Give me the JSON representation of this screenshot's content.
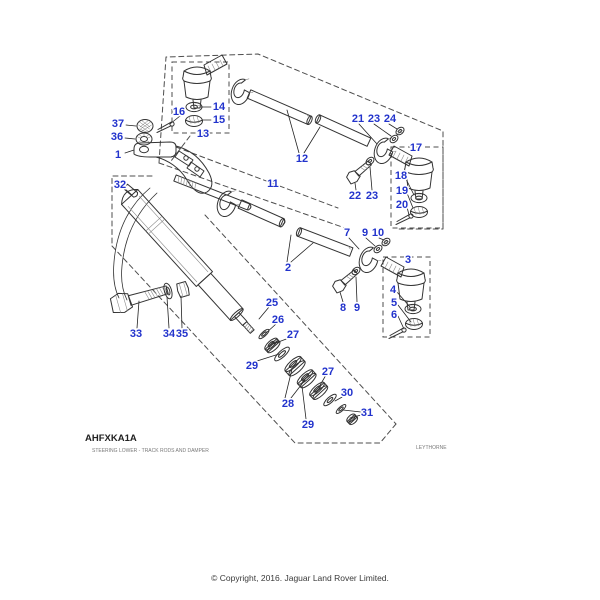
{
  "diagram": {
    "code": "AHFXKA1A",
    "subtitle": "STEERING LOWER - TRACK RODS AND DAMPER",
    "plant": "LEYTHORNE",
    "callout_color": "#2233cc",
    "callouts": [
      {
        "n": "1",
        "x": 118,
        "y": 155
      },
      {
        "n": "2",
        "x": 288,
        "y": 268
      },
      {
        "n": "3",
        "x": 408,
        "y": 260
      },
      {
        "n": "4",
        "x": 393,
        "y": 290
      },
      {
        "n": "5",
        "x": 394,
        "y": 303
      },
      {
        "n": "6",
        "x": 394,
        "y": 315
      },
      {
        "n": "7",
        "x": 347,
        "y": 233
      },
      {
        "n": "8",
        "x": 343,
        "y": 308
      },
      {
        "n": "9",
        "x": 365,
        "y": 233
      },
      {
        "n": "9",
        "x": 357,
        "y": 308
      },
      {
        "n": "10",
        "x": 378,
        "y": 233
      },
      {
        "n": "11",
        "x": 273,
        "y": 184
      },
      {
        "n": "12",
        "x": 302,
        "y": 159
      },
      {
        "n": "13",
        "x": 203,
        "y": 134
      },
      {
        "n": "14",
        "x": 219,
        "y": 107
      },
      {
        "n": "15",
        "x": 219,
        "y": 120
      },
      {
        "n": "16",
        "x": 179,
        "y": 112
      },
      {
        "n": "17",
        "x": 416,
        "y": 148
      },
      {
        "n": "18",
        "x": 401,
        "y": 176
      },
      {
        "n": "19",
        "x": 402,
        "y": 191
      },
      {
        "n": "20",
        "x": 402,
        "y": 205
      },
      {
        "n": "21",
        "x": 358,
        "y": 119
      },
      {
        "n": "22",
        "x": 355,
        "y": 196
      },
      {
        "n": "23",
        "x": 374,
        "y": 119
      },
      {
        "n": "23",
        "x": 372,
        "y": 196
      },
      {
        "n": "24",
        "x": 390,
        "y": 119
      },
      {
        "n": "25",
        "x": 272,
        "y": 303
      },
      {
        "n": "26",
        "x": 278,
        "y": 320
      },
      {
        "n": "27",
        "x": 293,
        "y": 335
      },
      {
        "n": "27",
        "x": 328,
        "y": 372
      },
      {
        "n": "28",
        "x": 288,
        "y": 404
      },
      {
        "n": "29",
        "x": 252,
        "y": 366
      },
      {
        "n": "29",
        "x": 308,
        "y": 425
      },
      {
        "n": "30",
        "x": 347,
        "y": 393
      },
      {
        "n": "31",
        "x": 367,
        "y": 413
      },
      {
        "n": "32",
        "x": 120,
        "y": 185
      },
      {
        "n": "33",
        "x": 136,
        "y": 334
      },
      {
        "n": "34",
        "x": 169,
        "y": 334
      },
      {
        "n": "35",
        "x": 182,
        "y": 334
      },
      {
        "n": "36",
        "x": 117,
        "y": 137
      },
      {
        "n": "37",
        "x": 118,
        "y": 124
      }
    ]
  },
  "footer": {
    "copyright": "© Copyright, 2016. Jaguar Land Rover Limited."
  }
}
